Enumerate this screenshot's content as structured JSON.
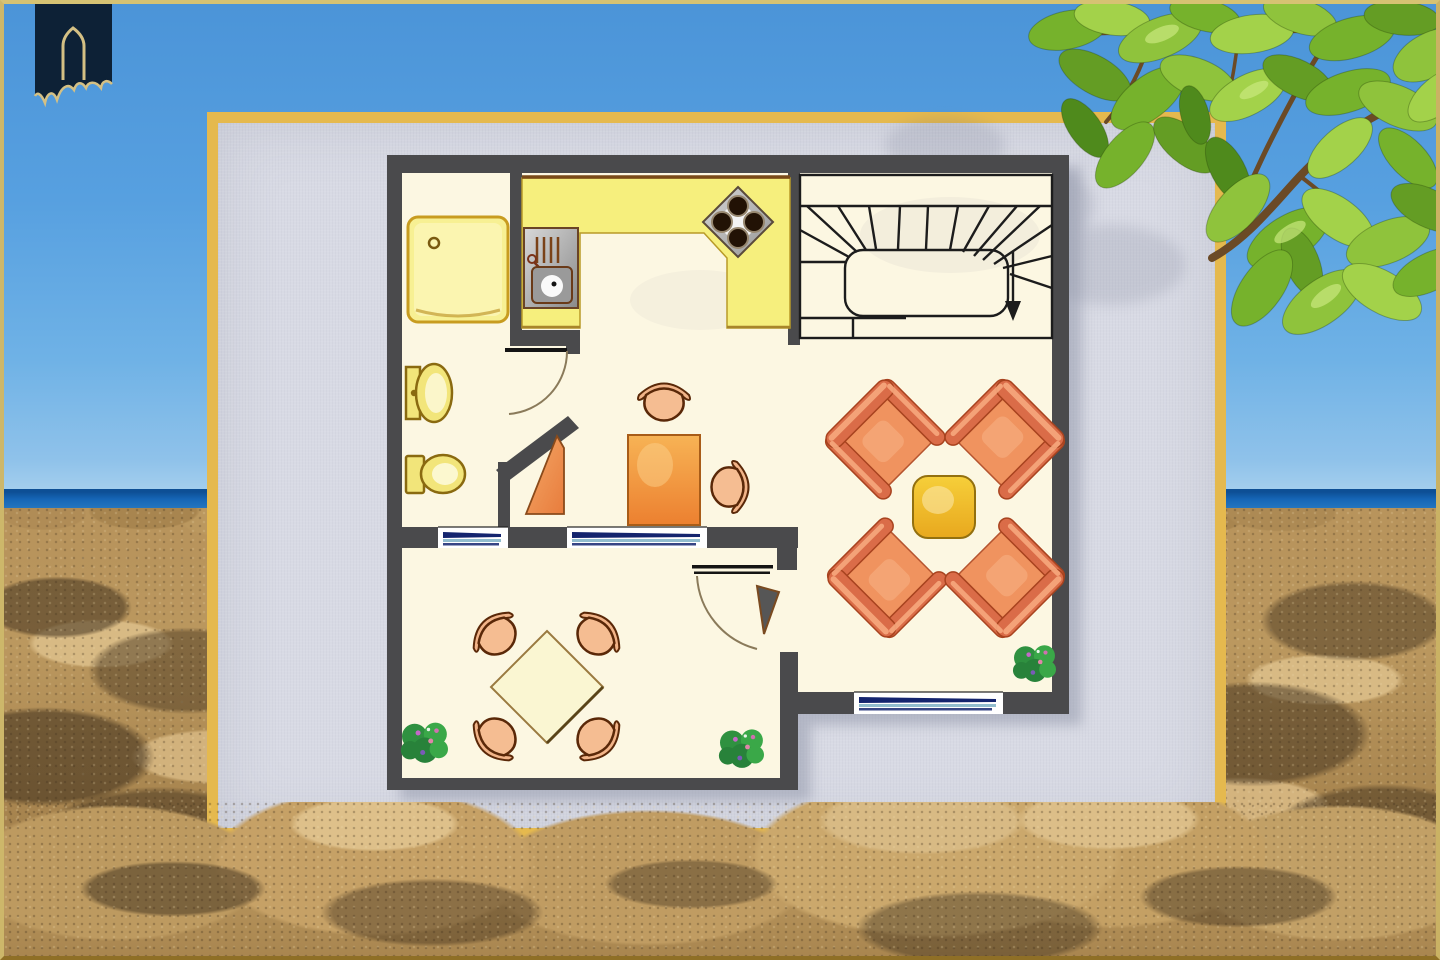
{
  "scene": {
    "description": "holiday-home floor plan flyer standing on a sunny beach",
    "background": [
      "blue-sky",
      "sea-horizon",
      "sandy-beach-with-dunes",
      "tree-branch-with-green-leaves-top-right"
    ],
    "logo": {
      "name": "estate-logo",
      "shape": "navy banner with gold pointed-arch house outline"
    }
  },
  "floor_plan": {
    "rooms": [
      {
        "name": "bathroom",
        "fixtures": [
          "shower",
          "washbasin",
          "toilet"
        ],
        "windows": 1
      },
      {
        "name": "kitchen",
        "fixtures": [
          "l-shaped-counter",
          "sink-unit",
          "stove-4-burners"
        ]
      },
      {
        "name": "staircase",
        "detail": "winder-stairs-with-down-arrow"
      },
      {
        "name": "hallway",
        "fixtures": [
          "corner-cupboard",
          "table",
          "2-chairs"
        ],
        "windows": 1,
        "doors": [
          "bathroom-door-with-swing-arc"
        ]
      },
      {
        "name": "living-area",
        "fixtures": [
          "4-armchairs",
          "coffee-table",
          "plant"
        ],
        "windows": 1
      },
      {
        "name": "dining-room",
        "fixtures": [
          "diagonal-square-table",
          "4-chairs",
          "2-plants"
        ],
        "doors": [
          "door-with-swing-arc-and-leaf"
        ]
      }
    ],
    "totals": {
      "windows": 3,
      "doors": 2,
      "plants": 3,
      "armchairs": 4,
      "small_chairs": 6
    }
  },
  "colors": {
    "wall": "#4a4a4c",
    "floor": "#fcf7e2",
    "card_bg": "#d8dae4",
    "card_border": "#e5b94e",
    "counter": "#f6ef7d",
    "shower": "#f7f093",
    "fixture_yellow": "#f2e57a",
    "fixture_stroke": "#8a6a10",
    "window_navy": "#14246e",
    "window_teal": "#7fb2c6",
    "stair_line": "#1c1c1c",
    "door_arc": "#8a7a5a",
    "armchair_seat": "#f0935f",
    "armchair_arm": "#da6c48",
    "chair_peach": "#f5bd92",
    "table_orange": "#f7b355",
    "coffee_table": "#f6cf3a",
    "dining_table": "#faf6d2",
    "plant_dark": "#28823a",
    "plant_mid": "#2f9140",
    "plant_light": "#3aa848",
    "branch": "#6b4a26",
    "logo_navy": "#0d2136",
    "logo_gold": "#d4c084",
    "sky_top": "#4b94d8",
    "sea": "#1565b5",
    "sand": "#bb985f"
  }
}
